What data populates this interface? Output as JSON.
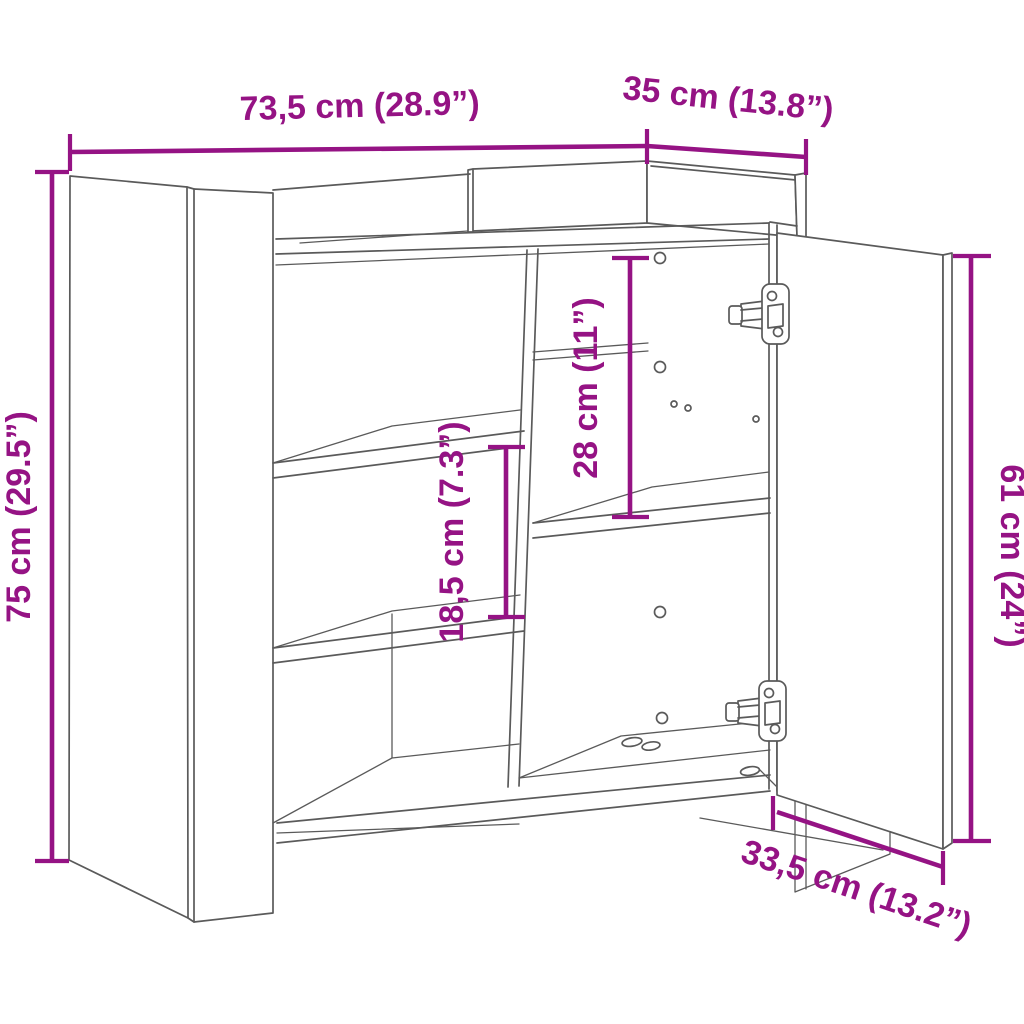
{
  "colors": {
    "dimension": "#951384",
    "outline": "#5a5a5a",
    "background": "#ffffff"
  },
  "dimensions": {
    "width": {
      "label": "73,5 cm (28.9”)"
    },
    "depth": {
      "label": "35 cm (13.8”)"
    },
    "height": {
      "label": "75 cm (29.5”)"
    },
    "left_shelf_spacing": {
      "label": "18,5 cm (7.3”)"
    },
    "right_compartment_height": {
      "label": "28 cm (11”)"
    },
    "door_height": {
      "label": "61 cm (24”)"
    },
    "door_width": {
      "label": "33,5 cm (13.2”)"
    }
  }
}
